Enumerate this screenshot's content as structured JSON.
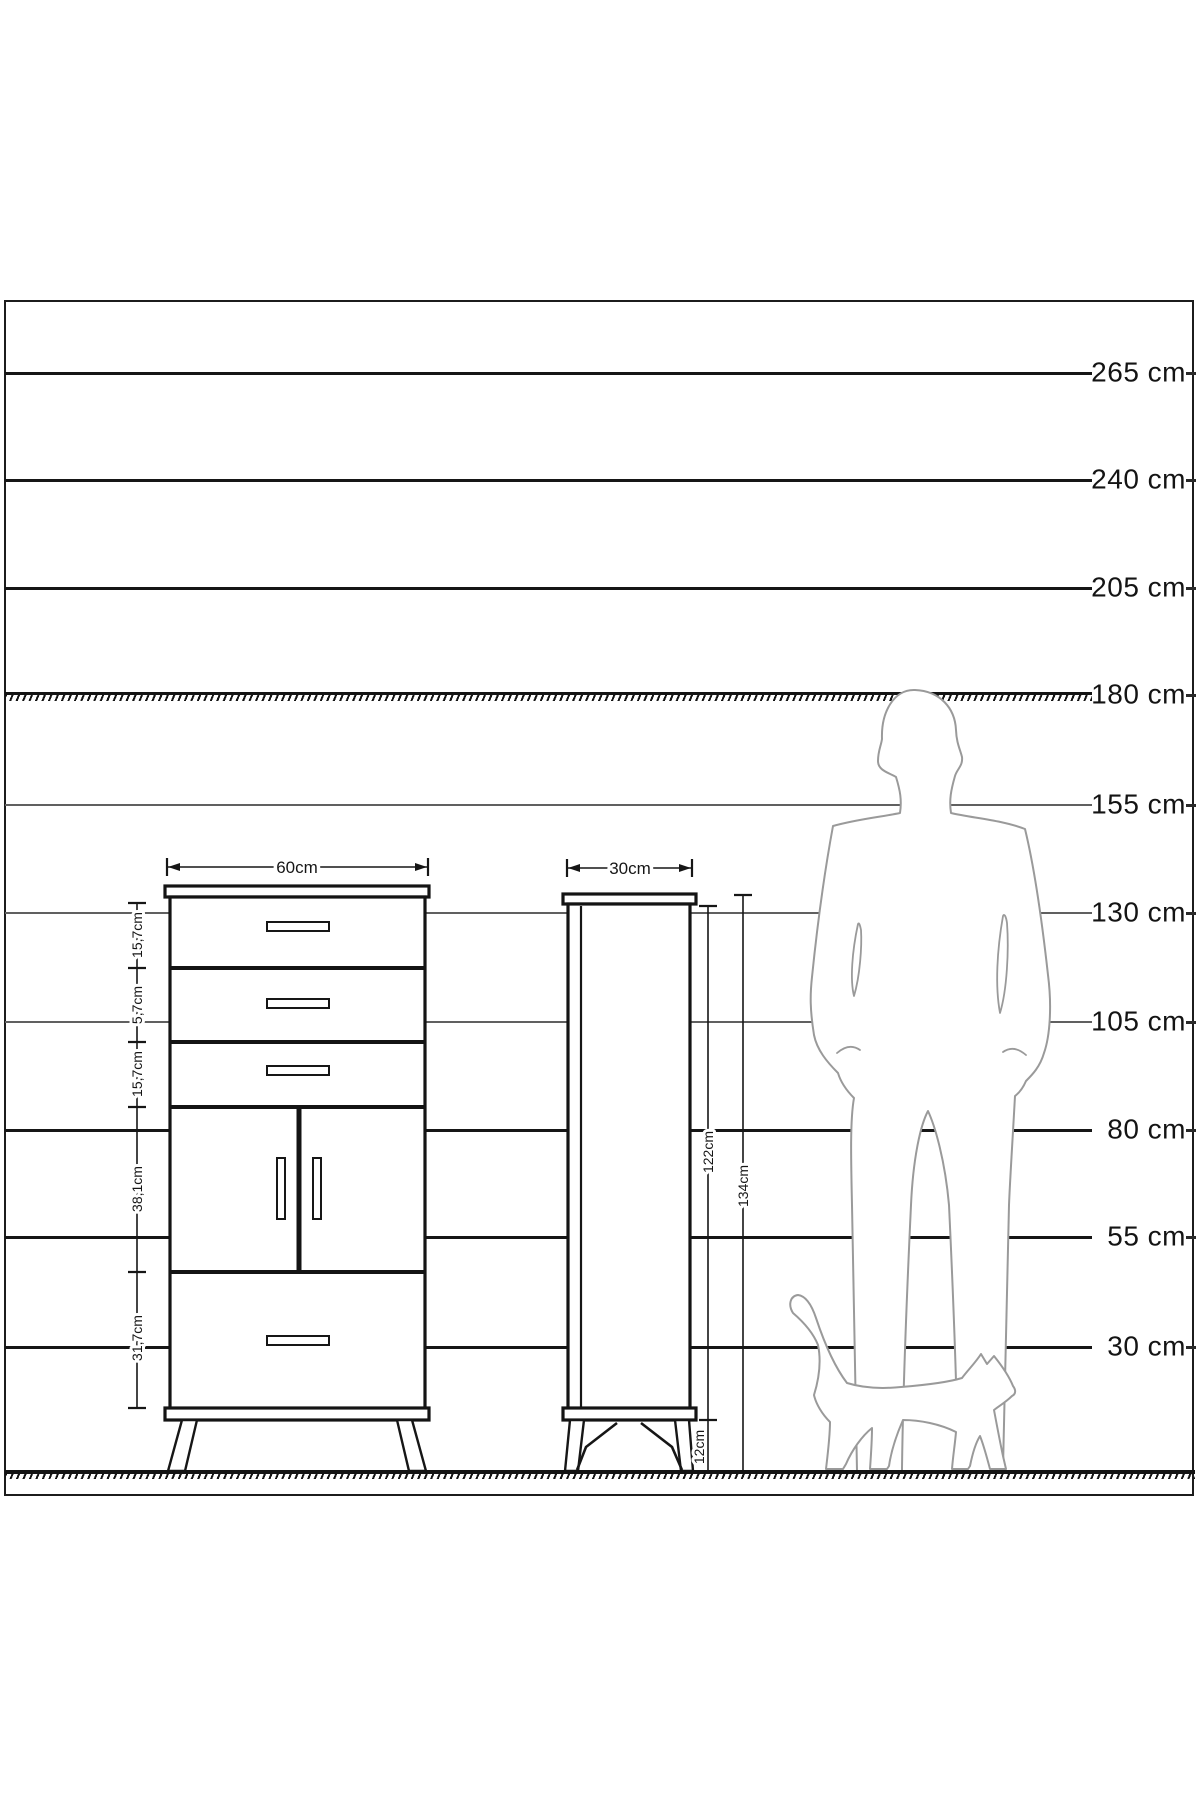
{
  "scale_labels": [
    "265 cm",
    "240 cm",
    "205 cm",
    "180 cm",
    "155 cm",
    "130 cm",
    "105 cm",
    "80 cm",
    "55 cm",
    "30 cm"
  ],
  "front_view": {
    "width_label": "60cm",
    "segment_labels": [
      "15,7cm",
      "5,7cm",
      "15,7cm",
      "38,1cm",
      "31,7cm"
    ]
  },
  "side_view": {
    "width_label": "30cm",
    "body_height_label": "122cm",
    "total_height_label": "134cm",
    "leg_height_label": "12cm"
  }
}
